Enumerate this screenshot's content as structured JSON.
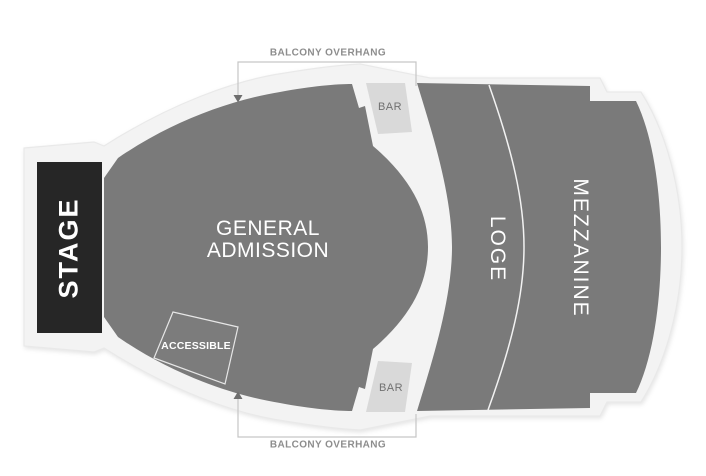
{
  "canvas": {
    "width": 706,
    "height": 476
  },
  "colors": {
    "section": "#7a7a7a",
    "frame": "#f3f3f3",
    "frame_edge": "#e9e9e9",
    "stage_bg": "#262626",
    "stage_text": "#ffffff",
    "label_text": "#ffffff",
    "bar_bg": "#d9d9d9",
    "bar_text": "#717171",
    "overhang_text": "#8d8d8d",
    "overhang_line": "#c6c6c6",
    "arrow": "#6e6e6e",
    "accessible_border": "#e6e6e6"
  },
  "sections": {
    "stage": {
      "label": "STAGE"
    },
    "general_admission": {
      "label_line1": "GENERAL",
      "label_line2": "ADMISSION"
    },
    "loge": {
      "label": "LOGE"
    },
    "mezzanine": {
      "label": "MEZZANINE"
    },
    "accessible": {
      "label": "ACCESSIBLE"
    },
    "bar_top": {
      "label": "BAR"
    },
    "bar_bottom": {
      "label": "BAR"
    }
  },
  "annotations": {
    "balcony_overhang_top": {
      "label": "BALCONY OVERHANG"
    },
    "balcony_overhang_bottom": {
      "label": "BALCONY OVERHANG"
    }
  }
}
